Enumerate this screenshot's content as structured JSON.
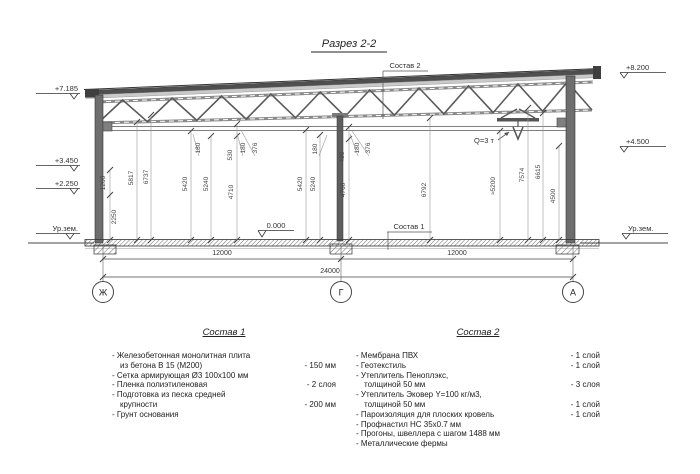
{
  "title": "Разрез 2-2",
  "section": {
    "elevations_left": [
      "+7.185",
      "+3.450",
      "+2.250",
      "Ур.зем."
    ],
    "elevations_right": [
      "+8.200",
      "+4.500",
      "Ур.зем."
    ],
    "floor_elevation": "0.000",
    "callouts": {
      "roof": "Состав 2",
      "floor": "Состав 1",
      "crane": "Q=3 т"
    },
    "vertical_dims": [
      "1200",
      "2250",
      "5817",
      "6737",
      "180",
      "5420",
      "5240",
      "530",
      "4710",
      "180",
      "376",
      "180",
      "5420",
      "5240",
      "480",
      "4760",
      "180",
      "376",
      "6792",
      "≈5200",
      "7574",
      "6615",
      "4500"
    ],
    "horizontal_dims": [
      "12000",
      "12000",
      "24000"
    ],
    "axes": [
      "Ж",
      "Г",
      "А"
    ]
  },
  "composition1": {
    "title": "Состав 1",
    "items": [
      {
        "lines": [
          "- Железобетонная монолитная плита",
          "из бетона В 15 (М200)"
        ],
        "value": "- 150 мм"
      },
      {
        "lines": [
          "- Сетка армирующая Ø3 100x100 мм"
        ],
        "value": ""
      },
      {
        "lines": [
          "- Пленка полиэтиленовая"
        ],
        "value": "- 2 слоя"
      },
      {
        "lines": [
          "- Подготовка из песка средней",
          "крупности"
        ],
        "value": "- 200 мм"
      },
      {
        "lines": [
          "- Грунт основания"
        ],
        "value": ""
      }
    ]
  },
  "composition2": {
    "title": "Состав 2",
    "items": [
      {
        "lines": [
          "- Мембрана ПВХ"
        ],
        "value": "- 1 слой"
      },
      {
        "lines": [
          "- Геотекстиль"
        ],
        "value": "- 1 слой"
      },
      {
        "lines": [
          "- Утеплитель Пеноплэкс,",
          "толщиной 50 мм"
        ],
        "value": "- 3 слоя"
      },
      {
        "lines": [
          "- Утеплитель Эковер Y=100 кг/м3,",
          "толщиной 50 мм"
        ],
        "value": "- 1 слой"
      },
      {
        "lines": [
          "- Пароизоляция для плоских кровель"
        ],
        "value": "- 1 слой"
      },
      {
        "lines": [
          "- Профнастил НС 35x0.7 мм"
        ],
        "value": ""
      },
      {
        "lines": [
          "- Прогоны, швеллера с шагом 1488 мм"
        ],
        "value": ""
      },
      {
        "lines": [
          "- Металлические фермы"
        ],
        "value": ""
      }
    ]
  }
}
